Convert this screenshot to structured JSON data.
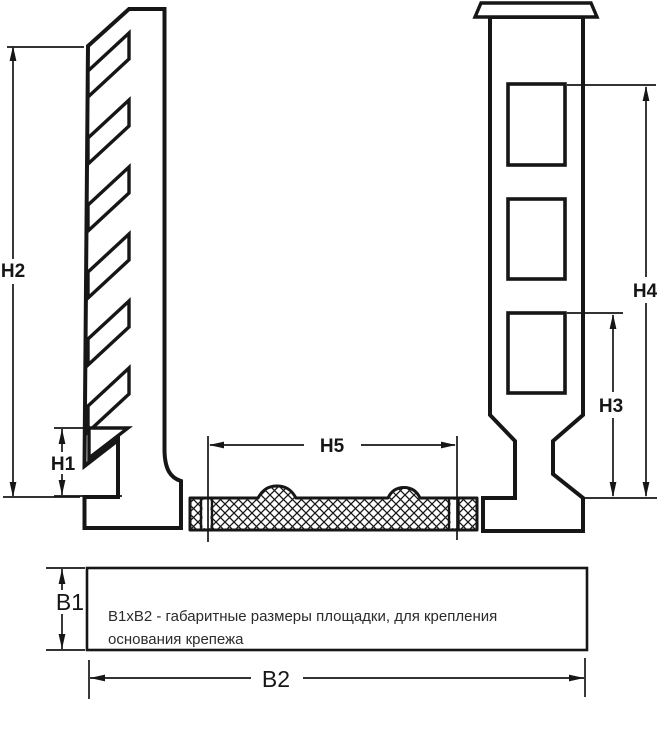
{
  "diagram": {
    "colors": {
      "ink": "#161616",
      "background": "#ffffff"
    },
    "dimensions": {
      "h1": {
        "label": "H1"
      },
      "h2": {
        "label": "H2"
      },
      "h3": {
        "label": "H3"
      },
      "h4": {
        "label": "H4"
      },
      "h5": {
        "label": "H5"
      },
      "b1": {
        "label": "B1"
      },
      "b2": {
        "label": "B2"
      }
    },
    "note": {
      "line1": "B1xB2 - габаритные размеры площадки, для крепления",
      "line2": "основания крепежа"
    }
  }
}
